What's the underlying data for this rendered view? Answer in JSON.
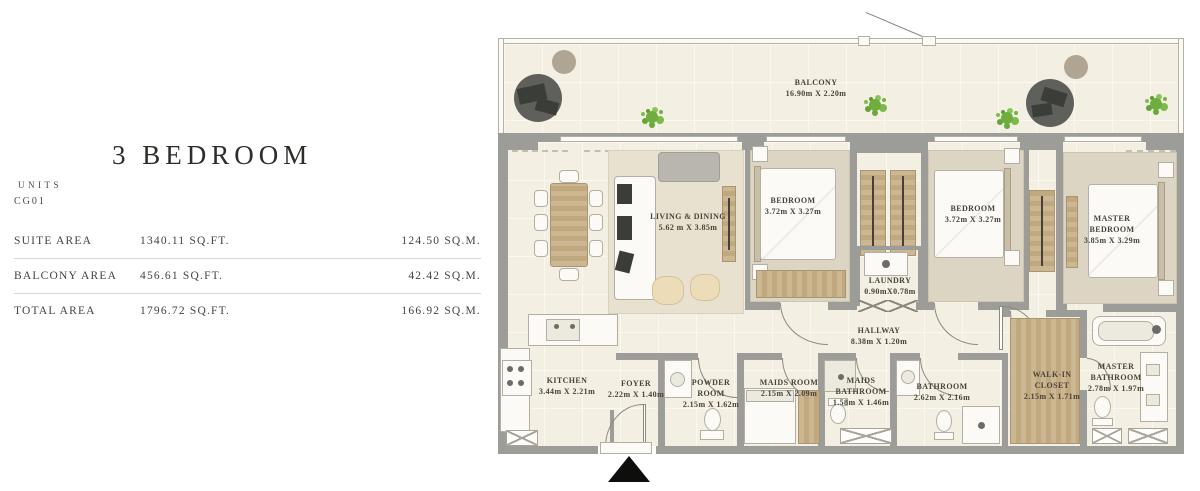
{
  "panel": {
    "title": "3 BEDROOM",
    "units_label": "UNITS",
    "unit_code": "CG01",
    "areas": [
      {
        "label": "SUITE AREA",
        "sqft": "1340.11 SQ.FT.",
        "sqm": "124.50 SQ.M."
      },
      {
        "label": "BALCONY AREA",
        "sqft": "456.61 SQ.FT.",
        "sqm": "42.42 SQ.M."
      },
      {
        "label": "TOTAL AREA",
        "sqft": "1796.72 SQ.FT.",
        "sqm": "166.92 SQ.M."
      }
    ]
  },
  "plan": {
    "rooms": [
      {
        "name": "BALCONY",
        "dims": "16.90m X 2.20m"
      },
      {
        "name": "LIVING & DINING",
        "dims": "5.62 m X 3.85m"
      },
      {
        "name": "BEDROOM",
        "dims": "3.72m X 3.27m"
      },
      {
        "name": "BEDROOM",
        "dims": "3.72m X 3.27m"
      },
      {
        "name": "MASTER BEDROOM",
        "dims": "3.85m X 3.29m"
      },
      {
        "name": "LAUNDRY",
        "dims": "0.90mX0.78m"
      },
      {
        "name": "HALLWAY",
        "dims": "8.38m X 1.20m"
      },
      {
        "name": "KITCHEN",
        "dims": "3.44m X 2.21m"
      },
      {
        "name": "FOYER",
        "dims": "2.22m X 1.40m"
      },
      {
        "name": "POWDER ROOM",
        "dims": "2.15m X 1.62m"
      },
      {
        "name": "MAIDS ROOM",
        "dims": "2.15m X 2.09m"
      },
      {
        "name": "MAIDS BATHROOM",
        "dims": "1.58m X 1.46m"
      },
      {
        "name": "BATHROOM",
        "dims": "2.62m X 2.16m"
      },
      {
        "name": "WALK-IN CLOSET",
        "dims": "2.15m X 1.71m"
      },
      {
        "name": "MASTER BATHROOM",
        "dims": "2.78m X 1.97m"
      }
    ],
    "colors": {
      "wall": "#9c9c98",
      "floor_tile": "#f3efe3",
      "carpet": "#ddd5c3",
      "wood": "#c8b18c",
      "plant_green": "#74b244",
      "label_text": "#49433a"
    }
  }
}
